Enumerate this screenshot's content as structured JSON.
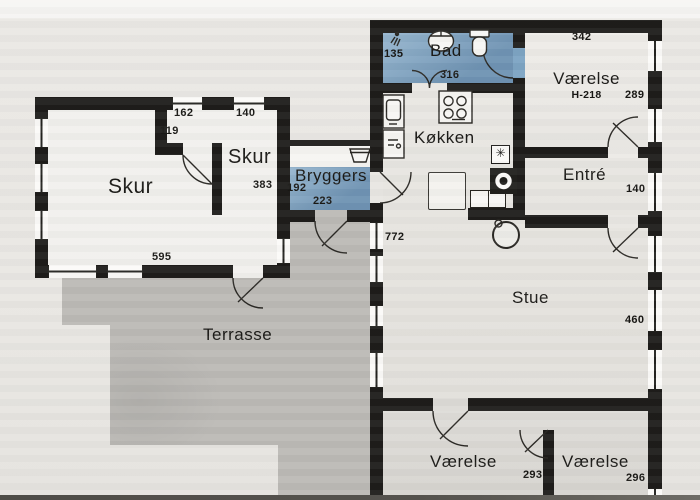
{
  "title": "Floor plan",
  "colors": {
    "wall": "#1e1d1b",
    "wet_room_blue": "#7da4c3",
    "terrace_gray": "#bcbab6",
    "room_light": "#f1f0ed",
    "paper": "#e9e7e3",
    "line": "#2b2925"
  },
  "rooms": {
    "skur_main": {
      "label": "Skur",
      "dim_bottom": "595",
      "dim_niche_width": "162",
      "dim_niche_depth": "119"
    },
    "skur_small": {
      "label": "Skur",
      "dim_top": "140",
      "dim_side": "383"
    },
    "bryggers": {
      "label": "Bryggers",
      "dim_left": "192",
      "dim_bottom": "223"
    },
    "bad": {
      "label": "Bad",
      "dim_left": "135",
      "dim_bottom": "316"
    },
    "vaerelse_ne": {
      "label": "Værelse",
      "dim_top": "342",
      "dim_ceiling": "H-218",
      "dim_right": "289"
    },
    "koekken": {
      "label": "Køkken"
    },
    "entre": {
      "label": "Entré",
      "dim_right": "140"
    },
    "stue": {
      "label": "Stue",
      "dim_right": "460",
      "dim_west_wall": "772"
    },
    "terrasse": {
      "label": "Terrasse"
    },
    "vaerelse_sw": {
      "label": "Værelse",
      "dim_right": "293"
    },
    "vaerelse_se": {
      "label": "Værelse",
      "dim_right": "296"
    }
  },
  "icons": {
    "fan_glyph": "✳",
    "shower": "shower-icon",
    "washbasin": "washbasin-icon",
    "toilet": "toilet-icon",
    "stove": "stove-icon",
    "kitchen_sink": "kitchen-sink-icon",
    "laundry_sink": "laundry-sink-icon",
    "chimney": "chimney-icon",
    "wood_stove": "wood-stove-icon"
  }
}
